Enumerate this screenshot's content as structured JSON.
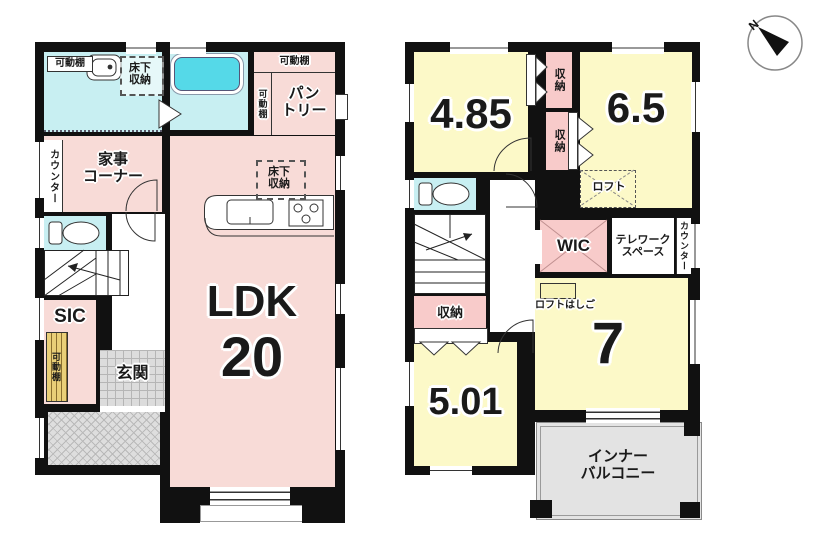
{
  "colors": {
    "wall_black": "#111111",
    "room_pink": "#f8dbd7",
    "room_yellow": "#fcf9c8",
    "room_cyan": "#c8eff2",
    "storage_pink": "#f8cbca",
    "tub_cyan": "#55d9e8",
    "tile_gray": "#dcdcdc",
    "balcony_gray": "#e3e3e3"
  },
  "compass": {
    "north_label": "N"
  },
  "floor1": {
    "washroom": {
      "shelf": "可動棚",
      "floor_storage_line1": "床下",
      "floor_storage_line2": "収納"
    },
    "pantry": {
      "shelf_top": "可動棚",
      "shelf_side": "可動棚",
      "name_line1": "パン",
      "name_line2": "トリー"
    },
    "kaji_corner": {
      "counter": "カウンター",
      "name_line1": "家事",
      "name_line2": "コーナー"
    },
    "ldk": {
      "name": "LDK",
      "size": "20",
      "floor_storage_line1": "床下",
      "floor_storage_line2": "収納"
    },
    "sic": {
      "name": "SIC",
      "shelf": "可動棚"
    },
    "genkan": {
      "name": "玄関"
    }
  },
  "floor2": {
    "room_485": {
      "size": "4.85",
      "closet": "収納"
    },
    "room_65": {
      "size": "6.5",
      "closet": "収納",
      "loft": "ロフト"
    },
    "wic": {
      "name": "WIC"
    },
    "telework": {
      "name_line1": "テレワーク",
      "name_line2": "スペース",
      "counter": "カウンター"
    },
    "room_501": {
      "size": "5.01",
      "closet": "収納"
    },
    "room_7": {
      "size": "7",
      "loft_ladder": "ロフトはしご"
    },
    "balcony": {
      "name_line1": "インナー",
      "name_line2": "バルコニー"
    }
  }
}
